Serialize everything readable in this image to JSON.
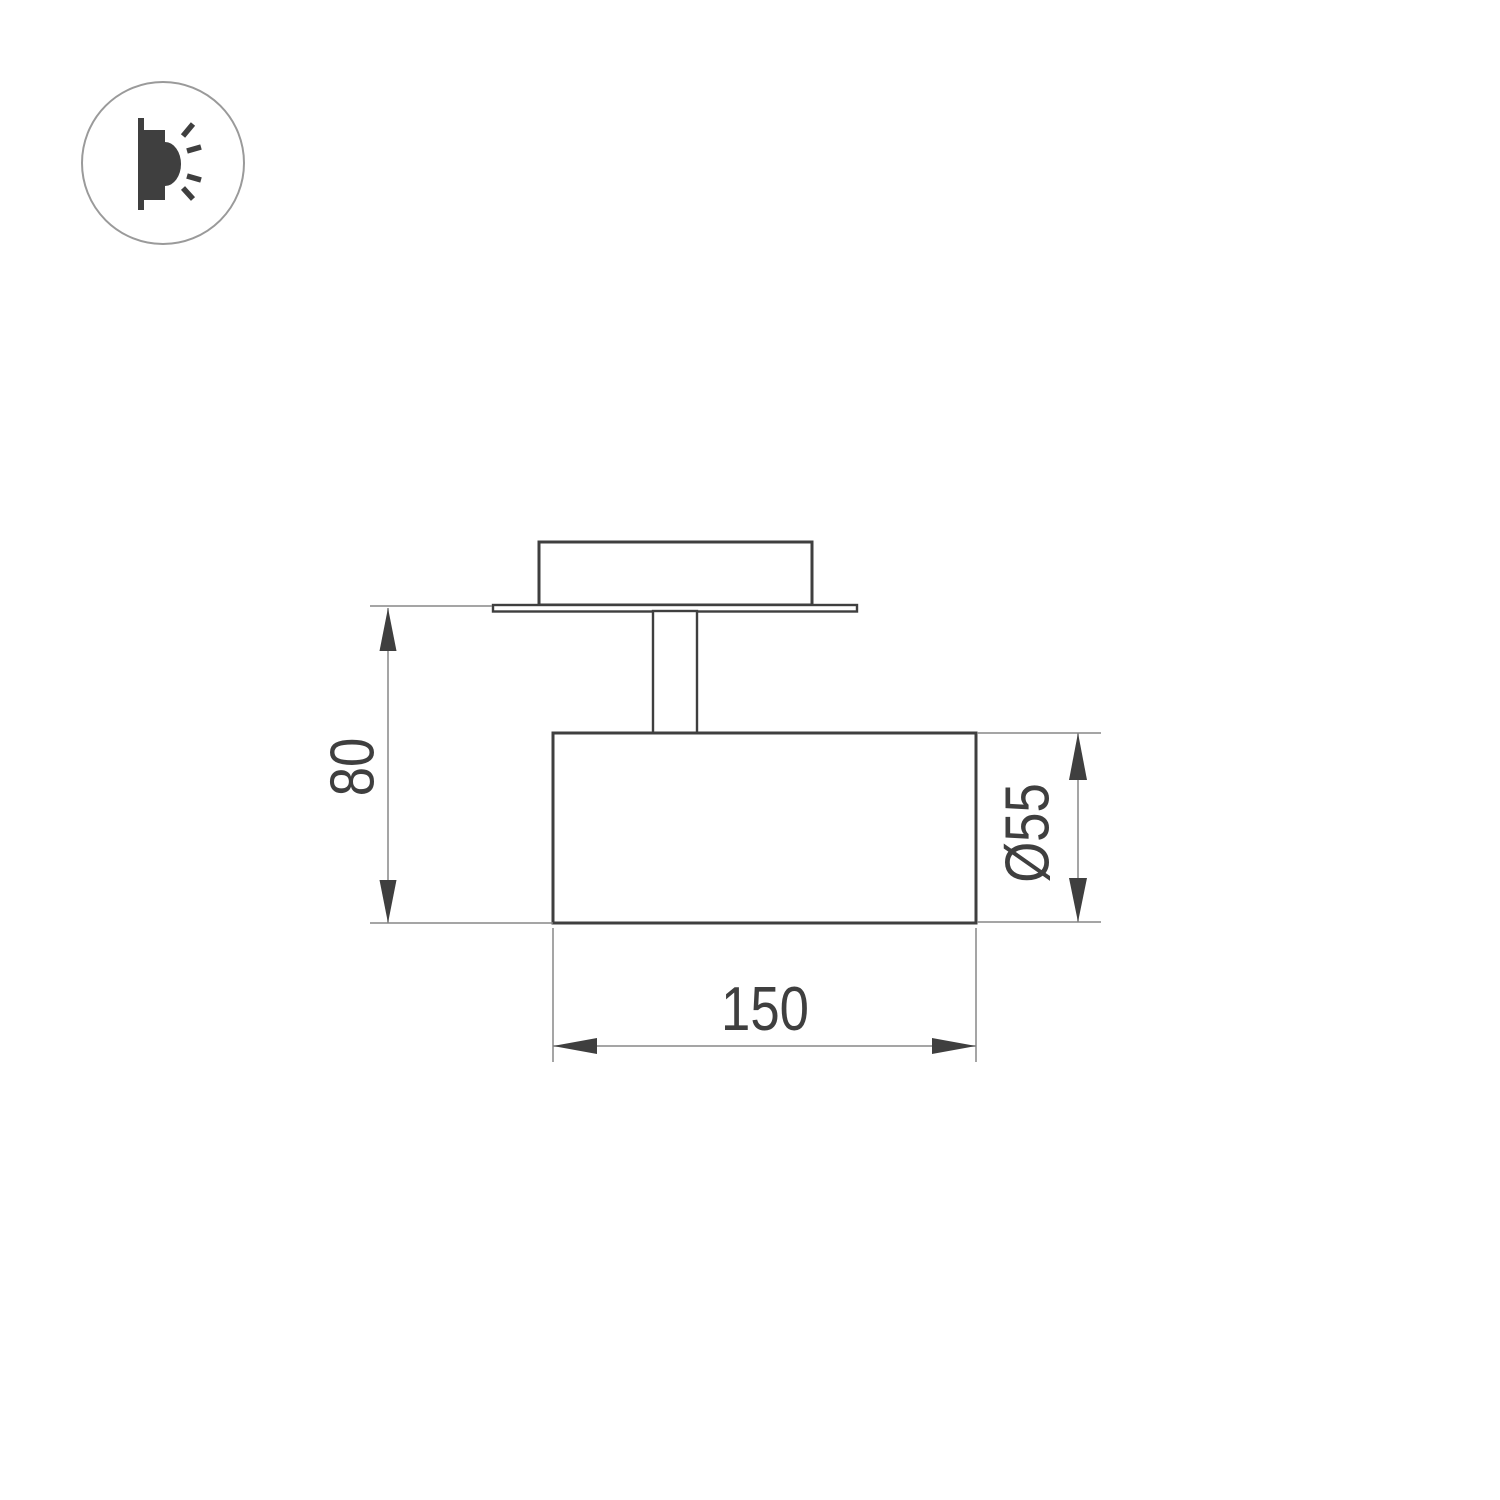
{
  "drawing": {
    "type": "technical-dimension-drawing",
    "subject": "surface-mounted-spot-light-fixture-side-view",
    "dimensions": {
      "height": {
        "label": "80",
        "orientation": "vertical-left"
      },
      "diameter": {
        "label": "Ø55",
        "orientation": "vertical-right"
      },
      "width": {
        "label": "150",
        "orientation": "horizontal-bottom"
      }
    }
  },
  "icons": {
    "mount_direction": "wall-light-icon"
  },
  "colors": {
    "line-dark": "#3f3f3f",
    "line-thin": "#878787",
    "icon-circle": "#9a9a9a",
    "bg": "#ffffff"
  }
}
